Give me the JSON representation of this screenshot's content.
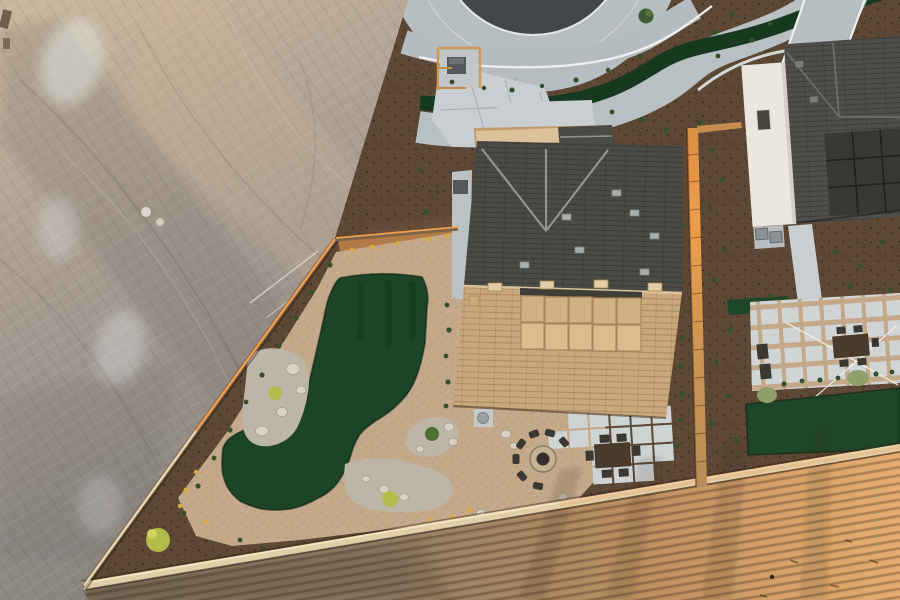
{
  "scene": {
    "description": "Aerial drone photograph at sunset: new desert home with artificial-turf putting green backyard, gravel loop path, boulder clusters, fire pit with chairs, paver patio with dining set, curving concrete sidewalks with white railing, neighboring white house with rooftop solar, wood privacy fence, block wall, graded dirt lot at left and plowed field below"
  },
  "colors": {
    "dirt_base": "#a79a8e",
    "asphalt": "#43474b",
    "asphalt_dark": "#373b3f",
    "concrete": "#b7bec2",
    "concrete_light": "#c9ced1",
    "railing": "#eef0ef",
    "mulch": "#5d4836",
    "mulch_lit": "#c08349",
    "path_tan": "#c3a88a",
    "gravel": "#bdb6a8",
    "turf": "#1c4527",
    "turf_street": "#173920",
    "turf_neighbor": "#1e4628",
    "roof_dark": "#4b4b46",
    "roof_ridge": "#90958f",
    "roof_tan": "#c9a87d",
    "roof_tan_light": "#dcc29a",
    "patio_cover_panel": "#d2b085",
    "patio_cover_edge": "#3f3e39",
    "house_wall": "#c49a6e",
    "window_dark": "#3a3631",
    "neighbor_wall": "#ece7de",
    "neighbor_roof": "#504e4a",
    "solar": "#3a3835",
    "wall_cap": "#e0cfa9",
    "wall_lit": "#f4e3bf",
    "fence_lit": "#f09e50",
    "fence_wood": "#7a6349",
    "boulder": "#d9d3c6",
    "boulder_tan": "#cfc3ae",
    "shrub": "#33512b",
    "sage": "#8fa06b",
    "bush_chartreuse": "#b2bc4a",
    "flower_yellow": "#dcab3f",
    "firepit_ring": "#c7b296",
    "firepit_center": "#35302b",
    "chair_dark": "#3b3733",
    "table_brown": "#4a3a2c",
    "paver": "#ced3d4",
    "equipment_gray": "#8d9194",
    "equip_box": "#54585a",
    "string_light": "#f4f4ee"
  }
}
